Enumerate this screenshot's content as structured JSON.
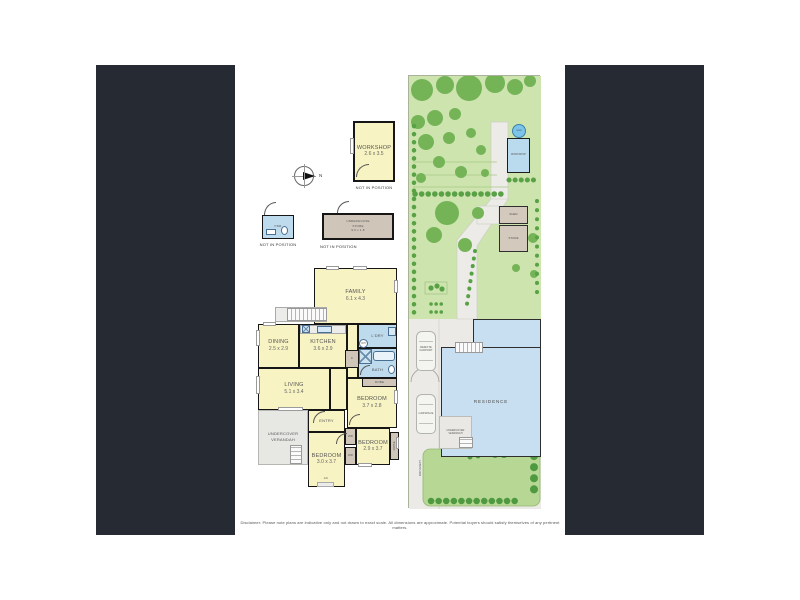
{
  "colors": {
    "panel_dark": "#262b33",
    "room_yellow": "#f8f3c2",
    "wet_blue": "#bedaed",
    "store_tan": "#cfc6b9",
    "garden_green": "#cde4af",
    "tree_green": "#74b457",
    "lawn_green": "#b7d794",
    "residence_blue": "#c8dff1"
  },
  "compass": {
    "north_label": "N"
  },
  "detached": {
    "workshop": {
      "label": "WORKSHOP",
      "dims": "2.6 x 3.5",
      "note": "NOT IN POSITION"
    },
    "powder": {
      "label": "PDR",
      "note": "NOT IN POSITION"
    },
    "store": {
      "line1": "UNDERHOUSE",
      "line2": "STORE",
      "dims": "9.0 x 1.8",
      "note": "NOT IN POSITION"
    }
  },
  "floorplan": {
    "family": {
      "label": "FAMILY",
      "dims": "6.1 x 4.3"
    },
    "dining": {
      "label": "DINING",
      "dims": "2.5 x 2.9"
    },
    "kitchen": {
      "label": "KITCHEN",
      "dims": "3.6 x 2.9"
    },
    "laundry": {
      "label": "L'DRY"
    },
    "bath": {
      "label": "BATH"
    },
    "robe_main": {
      "label": "ROBE"
    },
    "living": {
      "label": "LIVING",
      "dims": "5.1 x 3.4"
    },
    "bedroom1": {
      "label": "BEDROOM",
      "dims": "3.7 x 2.8"
    },
    "entry": {
      "label": "ENTRY"
    },
    "bedroom2": {
      "label": "BEDROOM",
      "dims": "3.0 x 3.7"
    },
    "bedroom3": {
      "label": "BEDROOM",
      "dims": "2.9 x 3.7"
    },
    "robe_side": {
      "label": "ROBE"
    },
    "wr1": {
      "label": "WR"
    },
    "wr2": {
      "label": "WR"
    },
    "cupboard": {
      "label": "C"
    },
    "water_heater": {
      "label": "WH"
    },
    "ac": {
      "label": "AC"
    },
    "verandah": {
      "line1": "UNDERCOVER",
      "line2": "VERANDAH"
    }
  },
  "siteplan": {
    "tank": {
      "label": "TANK"
    },
    "workshop": {
      "label": "WORKSHOP"
    },
    "shed": {
      "label": "SHED"
    },
    "store": {
      "label": "STORE"
    },
    "residence": {
      "label": "RESIDENCE"
    },
    "carport": {
      "line1": "REMOTE",
      "line2": "CARPORT"
    },
    "carspace": {
      "label": "CARSPACE"
    },
    "driveway": {
      "label": "DRIVEWAY"
    },
    "verandah": {
      "line1": "UNDERCOVER",
      "line2": "VERANDAH"
    }
  },
  "footer": {
    "disclaimer": "Disclaimer: Please note plans are indicative only and not drawn to exact scale. All dimensions are approximate. Potential buyers should satisfy themselves of any pertinent matters."
  }
}
